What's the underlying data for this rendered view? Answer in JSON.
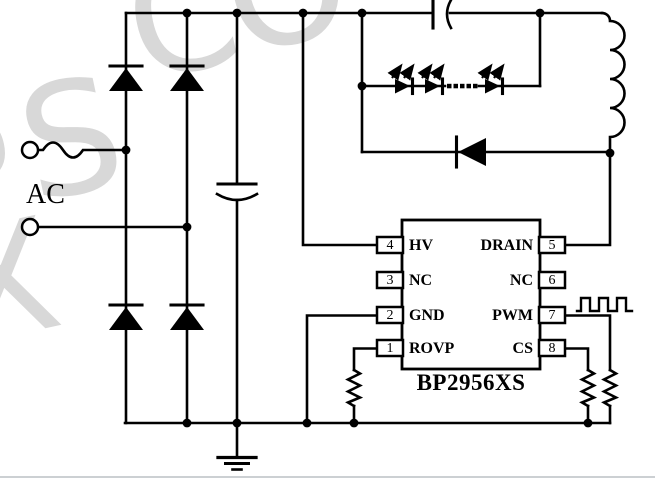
{
  "schematic": {
    "ac_label": "AC",
    "ic": {
      "name": "BP2956XS",
      "left_pins": [
        {
          "num": "4",
          "label": "HV"
        },
        {
          "num": "3",
          "label": "NC"
        },
        {
          "num": "2",
          "label": "GND"
        },
        {
          "num": "1",
          "label": "ROVP"
        }
      ],
      "right_pins": [
        {
          "num": "5",
          "label": "DRAIN"
        },
        {
          "num": "6",
          "label": "NC"
        },
        {
          "num": "7",
          "label": "PWM"
        },
        {
          "num": "8",
          "label": "CS"
        }
      ]
    },
    "watermark_letters": [
      "P",
      "S",
      "C",
      "O",
      "X"
    ],
    "colors": {
      "line": "#000000",
      "bg": "#ffffff",
      "wm": "#d8d8d8",
      "rule": "#ccd0d3"
    }
  }
}
